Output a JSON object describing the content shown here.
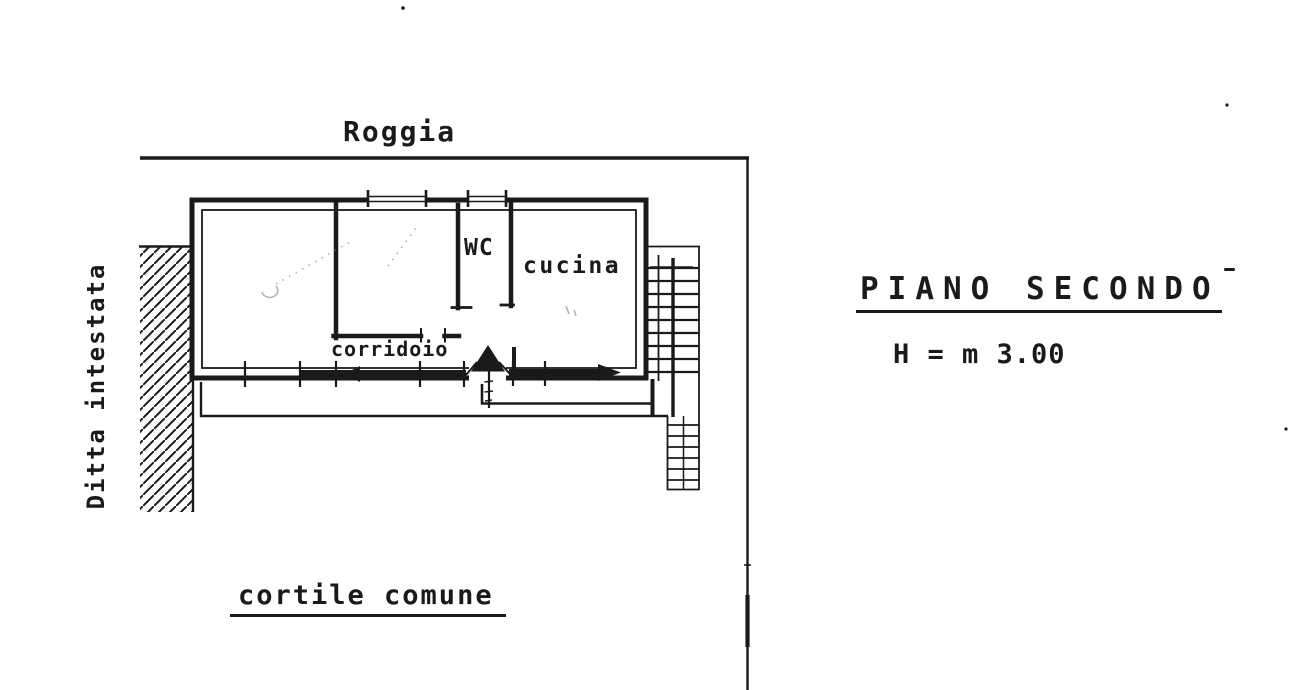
{
  "colors": {
    "ink": "#1a1a1a",
    "paper": "#ffffff"
  },
  "annotations": {
    "top_label": "Roggia",
    "left_label": "Ditta intestata",
    "bottom_label": "cortile comune",
    "title": "PIANO SECONDO",
    "height_note": "H = m 3.00"
  },
  "rooms": {
    "wc": "WC",
    "kitchen": "cucina",
    "corridor": "corridoio"
  }
}
